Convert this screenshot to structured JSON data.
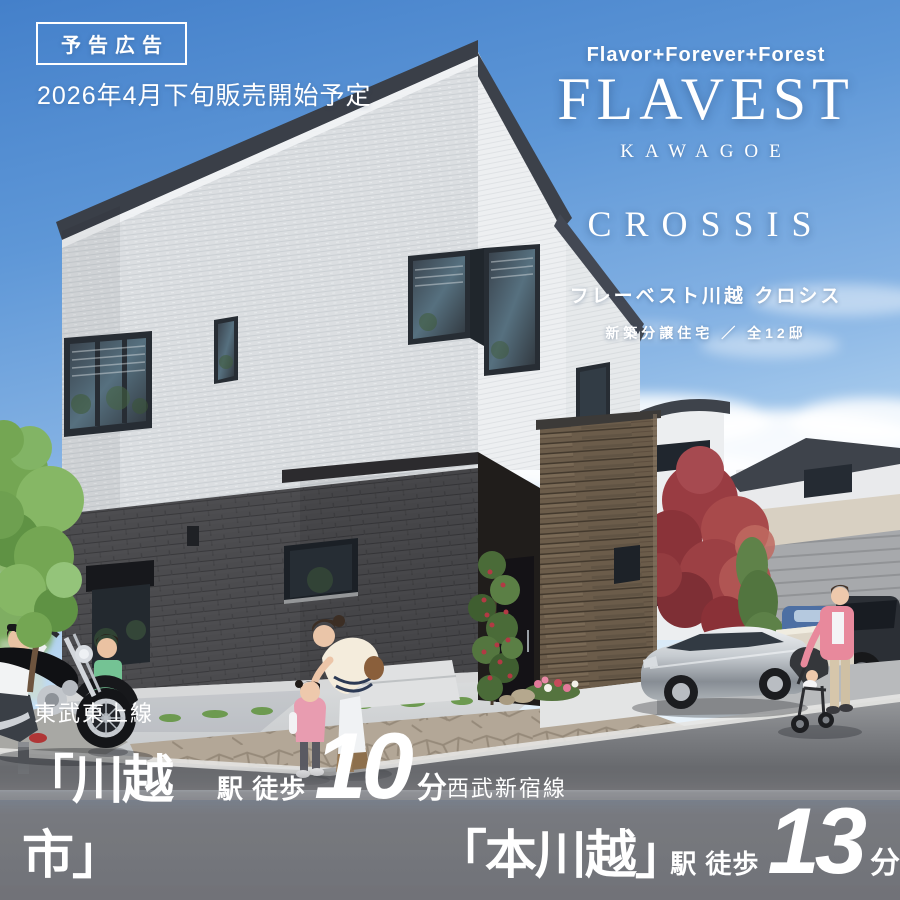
{
  "notice": {
    "badge_label": "予告広告",
    "sale_schedule": "2026年4月下旬販売開始予定"
  },
  "logo": {
    "tagline": "Flavor+Forever+Forest",
    "brand_name": "FLAVEST",
    "area_name": "KAWAGOE",
    "series_name": "CROSSIS",
    "name_japanese": "フレーベスト川越 クロシス",
    "property_type": "新築分譲住宅 ／ 全12邸"
  },
  "access": {
    "stations": [
      {
        "line": "東武東上線",
        "station": "「川越市」",
        "walk_label": "駅 徒歩",
        "minutes": "10",
        "unit": "分"
      },
      {
        "line": "西武新宿線",
        "station": "「本川越」",
        "walk_label": "駅 徒歩",
        "minutes": "13",
        "unit": "分"
      }
    ]
  },
  "colors": {
    "sky_blue": "#5e97d7",
    "text_white": "#ffffff",
    "access_bar_gray": "#7c7c80",
    "roof_dark": "#3a3f48",
    "white_siding": "#dbdee1",
    "brick_dark": "#4b4b4e",
    "wood_brown": "#6b5c4a"
  },
  "scene": {
    "objects": [
      "main-house",
      "wood-slat-wall",
      "entrance-door",
      "motorcycle",
      "motorcycle-rider",
      "boy-standing",
      "woman-bending",
      "toddler-girl",
      "woman-with-stroller",
      "stroller",
      "silver-sedan-car",
      "blue-car",
      "dark-suv-car",
      "background-houses",
      "garage-door",
      "red-maple-tree",
      "conifer-tree",
      "foreground-tree",
      "entrance-shrub",
      "flower-bed",
      "street"
    ]
  }
}
